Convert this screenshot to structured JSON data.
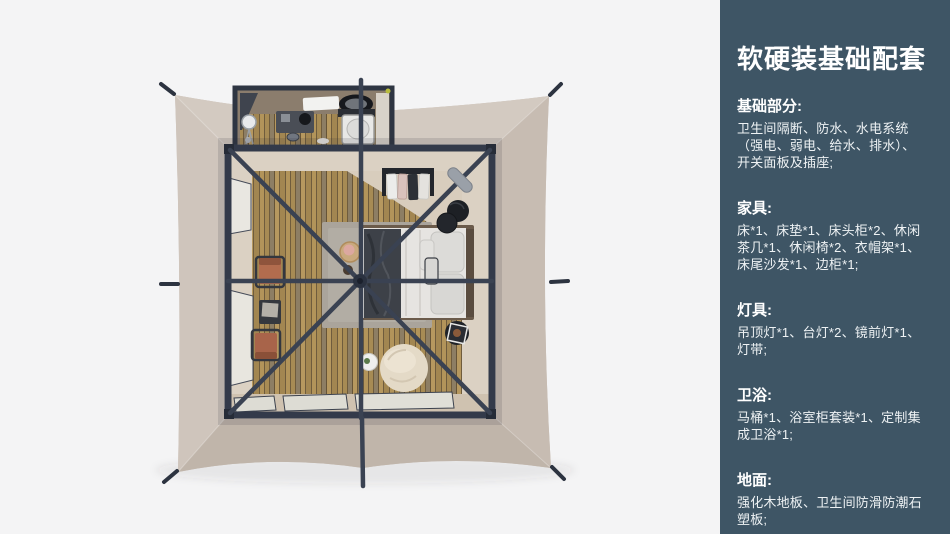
{
  "panel": {
    "title": "软硬装基础配套",
    "sections": [
      {
        "heading": "基础部分:",
        "lines": [
          "卫生间隔断、防水、水电系统",
          "（强电、弱电、给水、排水）、",
          "开关面板及插座;"
        ]
      },
      {
        "heading": "家具:",
        "lines": [
          "床*1、床垫*1、床头柜*2、休闲",
          "茶几*1、休闲椅*2、衣帽架*1、",
          "床尾沙发*1、边柜*1;"
        ]
      },
      {
        "heading": "灯具:",
        "lines": [
          "吊顶灯*1、台灯*2、镜前灯*1、",
          "灯带;"
        ]
      },
      {
        "heading": "卫浴:",
        "lines": [
          "马桶*1、浴室柜套装*1、定制集",
          "成卫浴*1;"
        ]
      },
      {
        "heading": "地面:",
        "lines": [
          "强化木地板、卫生间防滑防潮石",
          "塑板;"
        ]
      }
    ]
  },
  "colors": {
    "page_background": "#f4f4f5",
    "panel_background": "#3e5565",
    "panel_text": "#ffffff",
    "tent_canvas": "#cabfb6",
    "frame_dark": "#343b4b",
    "wood_floor": "#b2945a",
    "rug": "#aaa49b",
    "bedding": "#e6e4e1",
    "blanket": "#3d4148",
    "chair_terracotta": "#b06a4e",
    "beanbag": "#e4dac7"
  }
}
